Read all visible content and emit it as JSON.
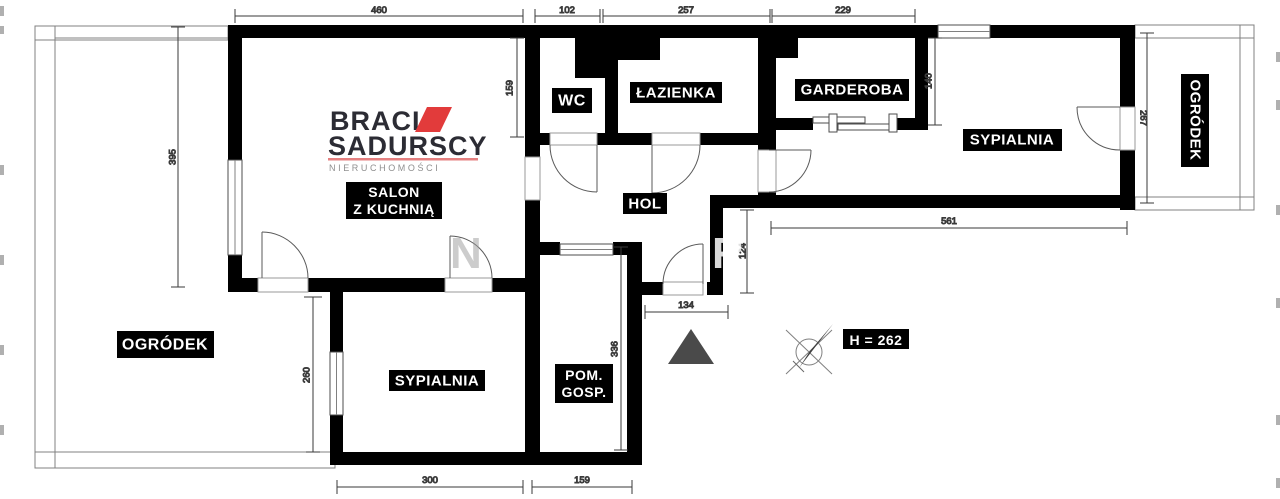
{
  "brand": {
    "name_line1": "BRACIA",
    "name_line2": "SADURSCY",
    "tagline": "NIERUCHOMOŚCI"
  },
  "rooms": {
    "salon_line1": "SALON",
    "salon_line2": "Z KUCHNIĄ",
    "wc": "WC",
    "bathroom": "ŁAZIENKA",
    "wardrobe": "GARDEROBA",
    "bedroom_right": "SYPIALNIA",
    "garden_right": "OGRÓDEK",
    "hall": "HOL",
    "garden_left": "OGRÓDEK",
    "bedroom_bottom": "SYPIALNIA",
    "utility_line1": "POM.",
    "utility_line2": "GOSP."
  },
  "annotations": {
    "ceiling_height": "H = 262",
    "watermark_letter_1": "N",
    "watermark_letter_2": "R"
  },
  "dims": {
    "top_1": "460",
    "top_2": "102",
    "top_3": "257",
    "top_4": "229",
    "left_salon": "395",
    "wc_height": "159",
    "wardrobe_height": "140",
    "garden_right_height": "267",
    "bedroom_right_width": "561",
    "entry_offset": "124",
    "entry_width": "134",
    "utility_height": "336",
    "garden_left_height": "260",
    "bedroom_bottom_width": "300",
    "utility_width": "159"
  },
  "colors": {
    "wall": "#000000",
    "accent_red": "#e23b3b",
    "accent_red_light": "#e58080",
    "logo_text": "#2c2c34",
    "triangle_gray": "#4a4a4a"
  }
}
